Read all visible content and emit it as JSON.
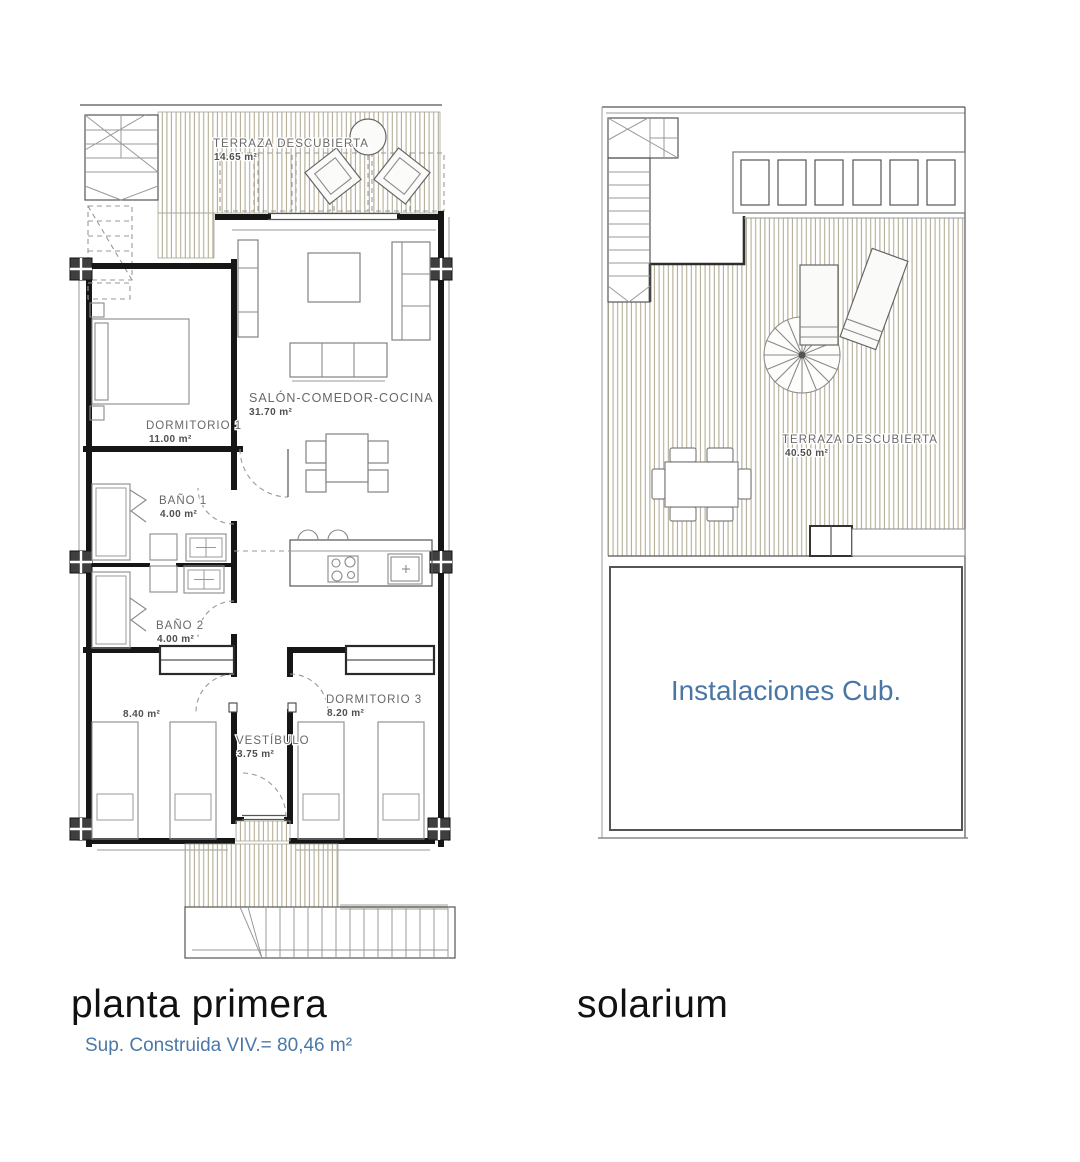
{
  "plans": {
    "planta_primera": {
      "caption": "planta primera",
      "area_note": "Sup. Construida VIV.= 80,46 m²",
      "rooms": {
        "terraza": {
          "name": "TERRAZA DESCUBIERTA",
          "area": "14.65 m²"
        },
        "salon": {
          "name": "SALÓN-COMEDOR-COCINA",
          "area": "31.70 m²"
        },
        "dormitorio1": {
          "name": "DORMITORIO 1",
          "area": "11.00 m²"
        },
        "bano1": {
          "name": "BAÑO 1",
          "area": "4.00 m²"
        },
        "bano2": {
          "name": "BAÑO 2",
          "area": "4.00 m²"
        },
        "dormitorio2": {
          "area": "8.40 m²"
        },
        "vestibulo": {
          "name": "VESTÍBULO",
          "area": "3.75 m²"
        },
        "dormitorio3": {
          "name": "DORMITORIO 3",
          "area": "8.20 m²"
        }
      }
    },
    "solarium": {
      "caption": "solarium",
      "rooms": {
        "terraza": {
          "name": "TERRAZA DESCUBIERTA",
          "area": "40.50 m²"
        },
        "instalaciones": {
          "name": "Instalaciones Cub."
        }
      }
    }
  },
  "colors": {
    "accent_blue": "#4a79a8",
    "hatch": "#b3ad95",
    "wall": "#161616"
  }
}
